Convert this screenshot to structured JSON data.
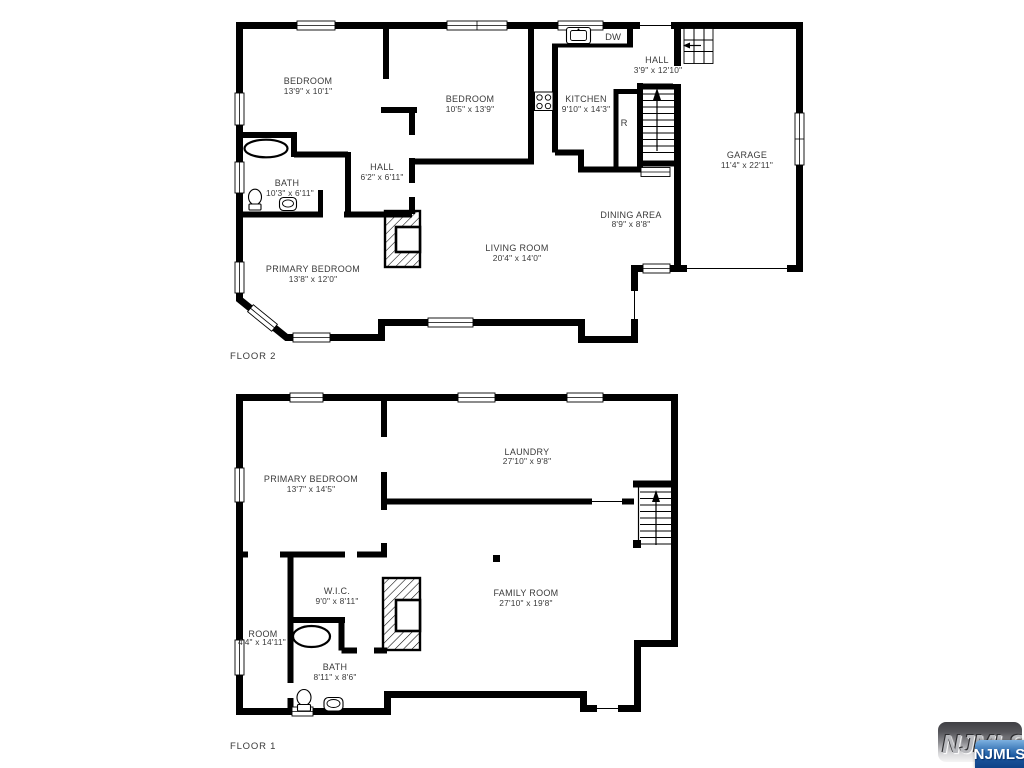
{
  "floor2": {
    "title": "FLOOR 2",
    "rooms": [
      {
        "label": "BEDROOM",
        "dims": "13'9\" x 10'1\""
      },
      {
        "label": "BEDROOM",
        "dims": "10'5\" x 13'9\""
      },
      {
        "label": "KITCHEN",
        "dims": "9'10\" x 14'3\""
      },
      {
        "label": "HALL",
        "dims": "3'9\" x 12'10\""
      },
      {
        "label": "GARAGE",
        "dims": "11'4\" x 22'11\""
      },
      {
        "label": "HALL",
        "dims": "6'2\" x 6'11\""
      },
      {
        "label": "BATH",
        "dims": "10'3\" x 6'11\""
      },
      {
        "label": "DINING AREA",
        "dims": "8'9\" x 8'8\""
      },
      {
        "label": "LIVING ROOM",
        "dims": "20'4\" x 14'0\""
      },
      {
        "label": "PRIMARY BEDROOM",
        "dims": "13'8\" x 12'0\""
      }
    ],
    "appliances": {
      "dishwasher": "DW",
      "refrigerator": "R"
    }
  },
  "floor1": {
    "title": "FLOOR 1",
    "rooms": [
      {
        "label": "PRIMARY BEDROOM",
        "dims": "13'7\" x 14'5\""
      },
      {
        "label": "LAUNDRY",
        "dims": "27'10\" x 9'8\""
      },
      {
        "label": "FAMILY ROOM",
        "dims": "27'10\" x 19'8\""
      },
      {
        "label": "W.I.C.",
        "dims": "9'0\" x 8'11\""
      },
      {
        "label": "ROOM",
        "dims": "4'4\" x 14'11\""
      },
      {
        "label": "BATH",
        "dims": "8'11\" x 8'6\""
      }
    ]
  },
  "watermark": {
    "embossed_text": "NJMLS",
    "badge_text": "NJMLS",
    "badge_color": "#1a559c"
  },
  "colors": {
    "wall": "#000000",
    "label_text": "#3a3a3a",
    "background": "#ffffff"
  }
}
